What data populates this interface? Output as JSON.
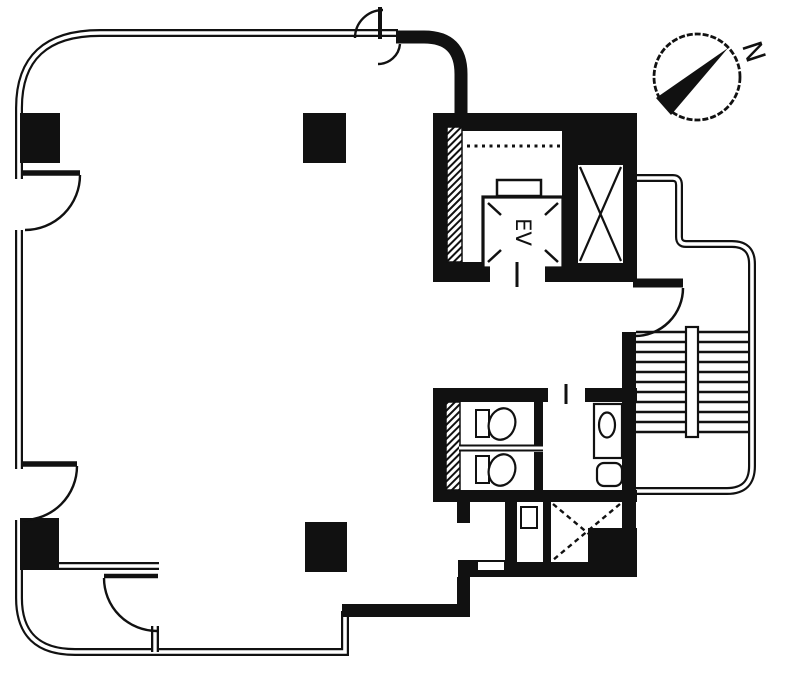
{
  "labels": {
    "elevator": "EV",
    "north": "N"
  },
  "colors": {
    "ink": "#111111",
    "background": "#ffffff"
  }
}
